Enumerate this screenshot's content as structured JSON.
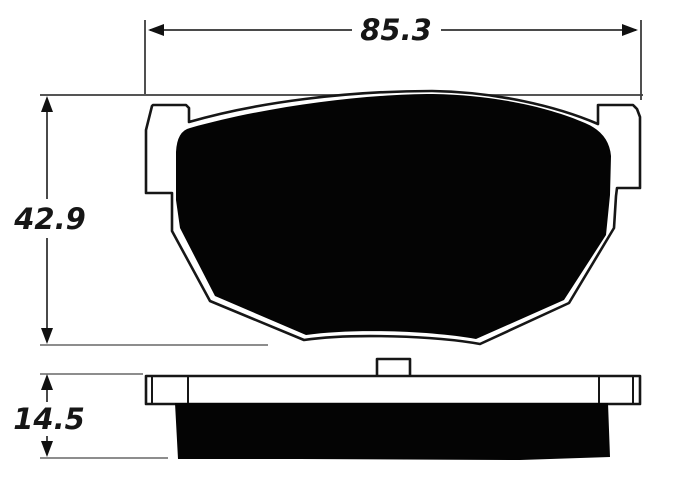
{
  "dimensions": {
    "width": {
      "value": "85.3"
    },
    "height": {
      "value": "42.9"
    },
    "thickness": {
      "value": "14.5"
    }
  },
  "colors": {
    "background": "#ffffff",
    "outline": "#161616",
    "friction_fill": "#040404",
    "dimension_line": "#4a4a4a",
    "extension_line_light": "#8d8d8d",
    "extension_line_dark": "#3d3d3d"
  }
}
